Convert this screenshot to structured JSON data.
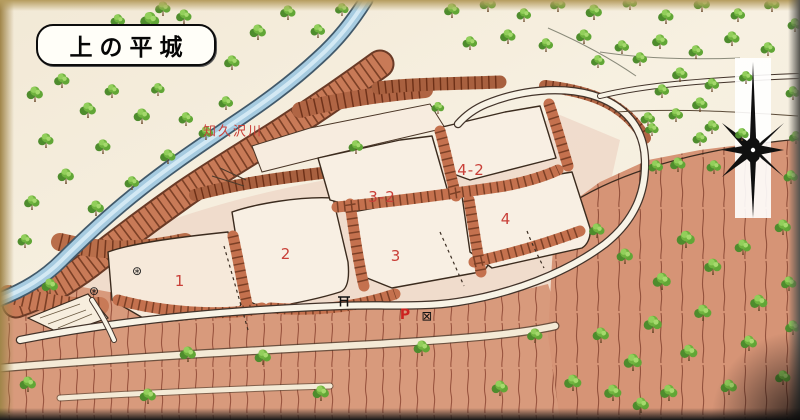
{
  "map": {
    "title": "上の平城",
    "river_label": "知久沢川",
    "areas": [
      {
        "label": "1"
      },
      {
        "label": "2"
      },
      {
        "label": "3"
      },
      {
        "label": "3-2"
      },
      {
        "label": "4"
      },
      {
        "label": "4-2"
      }
    ],
    "markers": {
      "parking": "P",
      "gate_box": "⊠",
      "shrine_left": "⊛",
      "shrine_right": "⊛"
    },
    "colors": {
      "label_red": "#c93f38",
      "river_blue": "#a6cbe0",
      "earth_salmon": "#c87a57",
      "terrace_salmon": "#d89a7c",
      "tree_green": "#61a636",
      "paper": "#f4ecdc",
      "compass_black": "#101010"
    }
  }
}
